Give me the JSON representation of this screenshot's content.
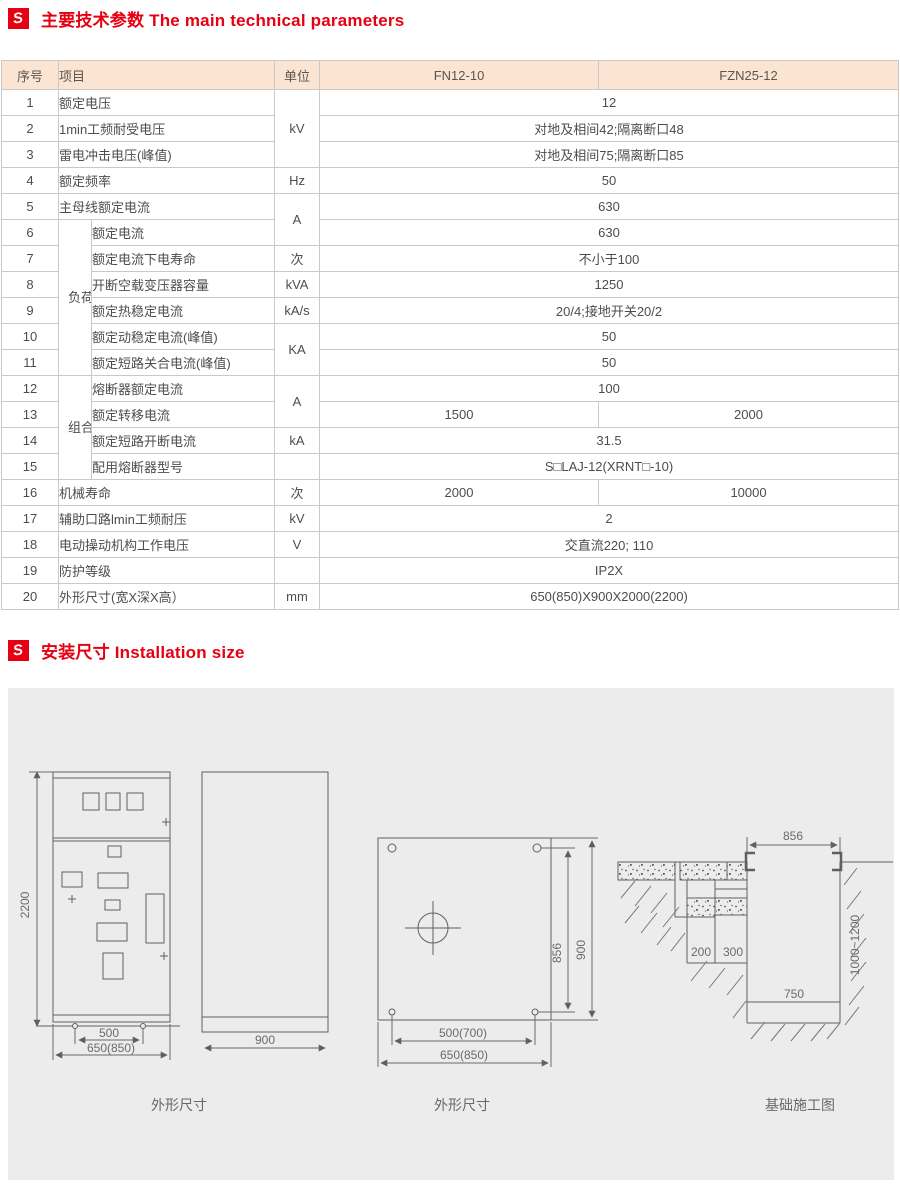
{
  "page": {
    "background": "#ffffff",
    "accent_color": "#e60012",
    "panel_color": "#ececec"
  },
  "section1": {
    "icon": "logo-icon",
    "icon_glyph": "S",
    "title": "主要技术参数 The main technical parameters"
  },
  "section2": {
    "icon": "logo-icon",
    "icon_glyph": "S",
    "title": "安装尺寸 Installation size"
  },
  "table": {
    "header": {
      "no": "序号",
      "item": "项目",
      "unit": "单位",
      "model1": "FN12-10",
      "model2": "FZN25-12"
    },
    "groups": {
      "g1": "负荷开关",
      "g2": "组合电器"
    },
    "rows": [
      {
        "no": "1",
        "item": "额定电压",
        "unit": "kV",
        "value": "12"
      },
      {
        "no": "2",
        "item": "1min工频耐受电压",
        "value": "对地及相间42;隔离断口48"
      },
      {
        "no": "3",
        "item": "雷电冲击电压(峰值)",
        "value": "对地及相间75;隔离断口85"
      },
      {
        "no": "4",
        "item": "额定频率",
        "unit": "Hz",
        "value": "50"
      },
      {
        "no": "5",
        "item": "主母线额定电流",
        "unit": "A",
        "value": "630"
      },
      {
        "no": "6",
        "item": "额定电流",
        "value": "630"
      },
      {
        "no": "7",
        "item": "额定电流下电寿命",
        "unit": "次",
        "value": "不小于100"
      },
      {
        "no": "8",
        "item": "开断空载变压器容量",
        "unit": "kVA",
        "value": "1250"
      },
      {
        "no": "9",
        "item": "额定热稳定电流",
        "unit": "kA/s",
        "value": "20/4;接地开关20/2"
      },
      {
        "no": "10",
        "item": "额定动稳定电流(峰值)",
        "unit": "KA",
        "value": "50"
      },
      {
        "no": "11",
        "item": "额定短路关合电流(峰值)",
        "value": "50"
      },
      {
        "no": "12",
        "item": "熔断器额定电流",
        "unit": "A",
        "value": "100"
      },
      {
        "no": "13",
        "item": "额定转移电流",
        "value1": "1500",
        "value2": "2000"
      },
      {
        "no": "14",
        "item": "额定短路开断电流",
        "unit": "kA",
        "value": "31.5"
      },
      {
        "no": "15",
        "item": "配用熔断器型号",
        "unit": "",
        "value": "S□LAJ-12(XRNT□-10)"
      },
      {
        "no": "16",
        "item": "机械寿命",
        "unit": "次",
        "value1": "2000",
        "value2": "10000"
      },
      {
        "no": "17",
        "item": "辅助口路lmin工频耐压",
        "unit": "kV",
        "value": "2"
      },
      {
        "no": "18",
        "item": "电动操动机构工作电压",
        "unit": "V",
        "value": "交直流220; 110"
      },
      {
        "no": "19",
        "item": "防护等级",
        "unit": "",
        "value": "IP2X"
      },
      {
        "no": "20",
        "item": "外形尺寸(宽X深X高）",
        "unit": "mm",
        "value": "650(850)X900X2000(2200)"
      }
    ]
  },
  "drawings": {
    "front": {
      "caption": "外形尺寸",
      "height": "2200",
      "hole_pitch": "500",
      "width": "650(850)",
      "depth": "900"
    },
    "plan": {
      "caption": "外形尺寸",
      "hole_height": "856",
      "depth": "900",
      "hole_width": "500(700)",
      "width": "650(850)"
    },
    "foundation": {
      "caption": "基础施工图",
      "opening": "856",
      "trench_depth": "1000~1200",
      "step_left": "200",
      "step_right": "300",
      "pit_width": "750"
    }
  }
}
